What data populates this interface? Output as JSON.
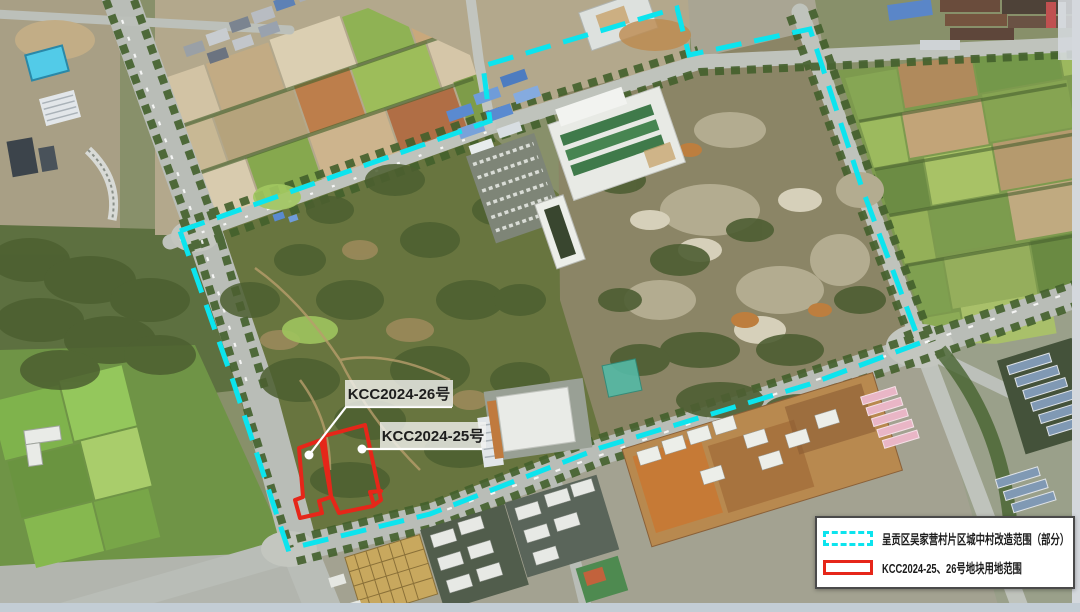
{
  "map": {
    "type": "satellite-annotation-map",
    "annotations": {
      "parcel26_label": "KCC2024-26号",
      "parcel25_label": "KCC2024-25号"
    },
    "legend": {
      "items": [
        {
          "swatch": "cyan-dashed-rectangle",
          "label": "呈贡区吴家营村片区城中村改造范围（部分）"
        },
        {
          "swatch": "red-solid-rectangle",
          "label": "KCC2024-25、26号地块用地范围"
        }
      ]
    },
    "colors": {
      "boundary_cyan": "#0ce4ee",
      "parcel_red": "#e62619",
      "legend_border": "#4a4a4a",
      "label_text": "#1d1d1d",
      "legend_background": "#ffffff"
    }
  }
}
